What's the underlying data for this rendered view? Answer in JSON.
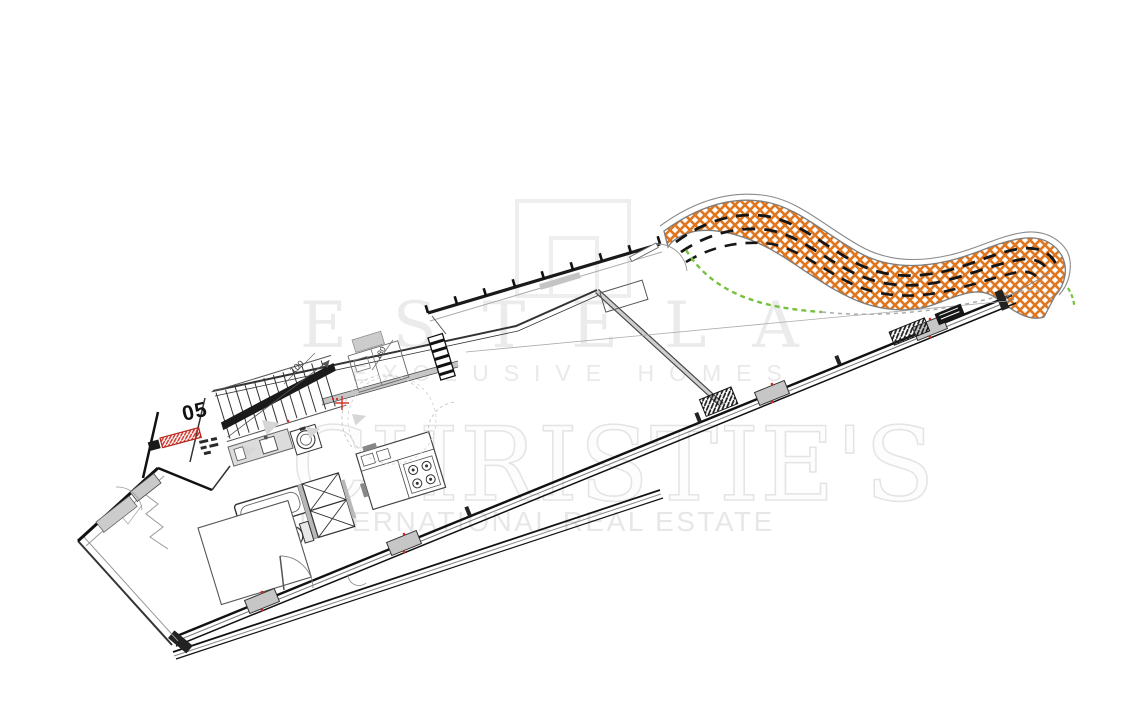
{
  "meta": {
    "background": "#ffffff",
    "description": "Tilted architectural floor plan of apartment unit 05 with large terrace, glass facades and a curved cross-hatched road at the top right, overlaid with real-estate brand watermarks"
  },
  "watermarks": {
    "estela": {
      "logo": "estela-square-logo",
      "name": "ESTELA",
      "tagline": "EXCLUSIVE HOMES",
      "color": "#ebebeb"
    },
    "christies": {
      "name": "CHRISTIE'S",
      "tagline": "INTERNATIONAL REAL ESTATE",
      "color": "#e7e7e7"
    }
  },
  "plan": {
    "unit_label": "05",
    "dimensions": [
      {
        "text": "100"
      },
      {
        "text": "180"
      }
    ],
    "colors": {
      "walls": "#1a1a1a",
      "secondary_walls": "#999999",
      "road_hatch_orange": "#e0761f",
      "road_dashes": "#151515",
      "path_dashed_green": "#76c13e",
      "path_dashed_gray": "#aaaaaa",
      "marker_red": "#d42a20",
      "mullion_gray": "#c6c6c6"
    },
    "features": [
      "curved-road-crosshatch",
      "boundary-fence-with-posts",
      "terrace",
      "glass-facade-sliding-doors",
      "staircase",
      "door-swing-arcs",
      "kitchen-island-with-hob",
      "kitchen-counter-with-sink",
      "round-washbasin",
      "bathtub",
      "toilet",
      "cross-hatched-shower",
      "bed",
      "red-electrical-panel",
      "utility-column"
    ]
  }
}
